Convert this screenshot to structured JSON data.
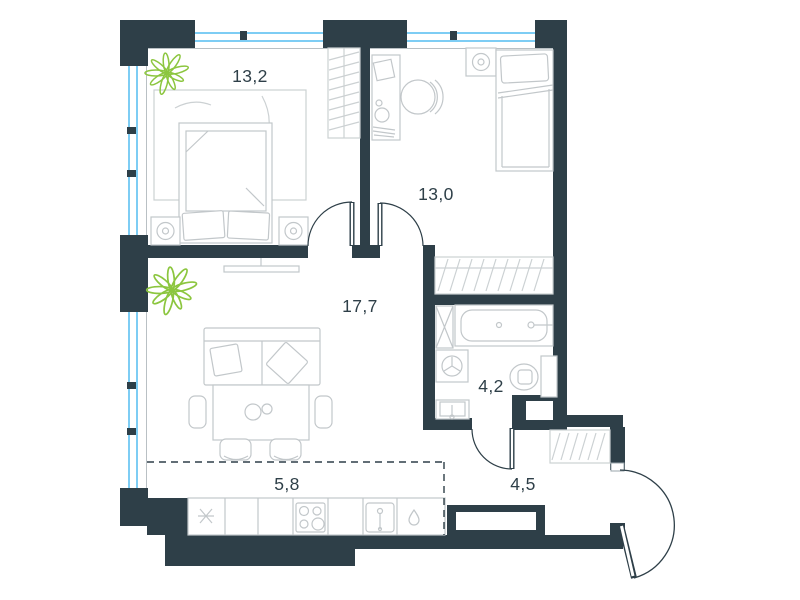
{
  "plan": {
    "type": "apartment-floor-plan",
    "rooms": [
      {
        "id": "bedroom-1",
        "area_label": "13,2"
      },
      {
        "id": "bedroom-2",
        "area_label": "13,0"
      },
      {
        "id": "living-room",
        "area_label": "17,7"
      },
      {
        "id": "kitchen-zone",
        "area_label": "5,8"
      },
      {
        "id": "bathroom",
        "area_label": "4,2"
      },
      {
        "id": "hallway",
        "area_label": "4,5"
      }
    ],
    "colors": {
      "wall": "#2e3f48",
      "window_glass": "#7ecdf4",
      "furniture_line": "#c2c7ca",
      "hatch_line": "#ccd1d3",
      "plant": "#8cc63f",
      "label_text": "#2e3f48"
    }
  }
}
